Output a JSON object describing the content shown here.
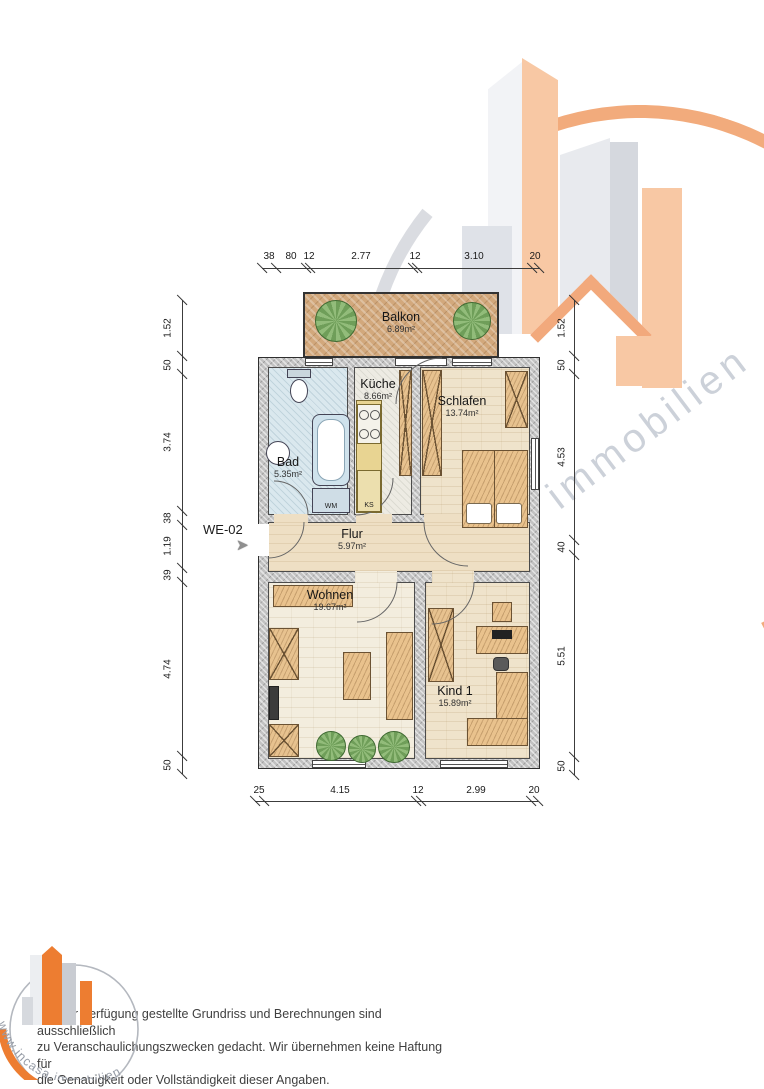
{
  "plan": {
    "unit_label": "WE-02",
    "rooms": {
      "balkon": {
        "name": "Balkon",
        "area": "6.89m²"
      },
      "kueche": {
        "name": "Küche",
        "area": "8.66m²"
      },
      "schlafen": {
        "name": "Schlafen",
        "area": "13.74m²"
      },
      "bad": {
        "name": "Bad",
        "area": "5.35m²"
      },
      "flur": {
        "name": "Flur",
        "area": "5.97m²"
      },
      "wohnen": {
        "name": "Wohnen",
        "area": "19.67m²"
      },
      "kind1": {
        "name": "Kind 1",
        "area": "15.89m²"
      }
    },
    "appliances": {
      "washing_machine": "WM",
      "fridge": "KS"
    }
  },
  "dims": {
    "top": [
      "38",
      "80",
      "12",
      "2.77",
      "12",
      "3.10",
      "20"
    ],
    "bottom": [
      "25",
      "4.15",
      "12",
      "2.99",
      "20"
    ],
    "left": [
      "1.52",
      "50",
      "3.74",
      "38",
      "1.19",
      "39",
      "4.74",
      "50"
    ],
    "right": [
      "1.52",
      "50",
      "4.53",
      "40",
      "5.51",
      "50"
    ]
  },
  "watermark": {
    "text": "immobilien"
  },
  "logo": {
    "url_text": "www.incasa.immobilien"
  },
  "footer": {
    "disclaimer_lines": [
      "Der zur Verfügung gestellte Grundriss und Berechnungen sind ausschließlich",
      "zu Veranschaulichungszwecken gedacht. Wir übernehmen keine Haftung für",
      "die Genauigkeit oder Vollständigkeit dieser Angaben."
    ]
  },
  "colors": {
    "brand_orange": "#ED7D31",
    "peach": "#F8C8A4",
    "watermark_gray": "#DADCE1"
  }
}
